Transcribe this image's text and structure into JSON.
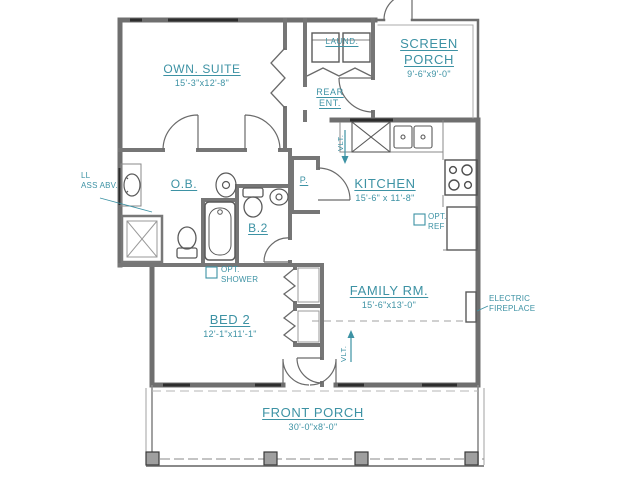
{
  "colors": {
    "accent": "#3d92a4",
    "wall": "#6f6f6f",
    "window": "#2d2d2d"
  },
  "rooms": {
    "own_suite": {
      "label": "OWN. SUITE",
      "dims": "15'-3\"x12'-8\""
    },
    "screen_porch": {
      "label": "SCREEN PORCH",
      "dims": "9'-6\"x9'-0\""
    },
    "laundry": {
      "label": "LAUND."
    },
    "rear_entry": {
      "label": "REAR ENT."
    },
    "kitchen": {
      "label": "KITCHEN",
      "dims": "15'-6\" x 11'-8\""
    },
    "owners_bath": {
      "label": "O.B."
    },
    "bath_2": {
      "label": "B.2"
    },
    "pantry": {
      "label": "P."
    },
    "bed_2": {
      "label": "BED 2",
      "dims": "12'-1\"x11'-1\""
    },
    "family_room": {
      "label": "FAMILY RM.",
      "dims": "15'-6\"x13'-0\""
    },
    "front_porch": {
      "label": "FRONT PORCH",
      "dims": "30'-0\"x8'-0\""
    }
  },
  "annotations": {
    "vault_kitchen": "VLT.",
    "vault_family": "VLT.",
    "opt_ref": "OPT. REF",
    "opt_shower": "OPT. SHOWER",
    "electric_fireplace": "ELECTRIC FIREPLACE",
    "glass_above_line1": "LL",
    "glass_above_line2": "ASS ABV."
  }
}
